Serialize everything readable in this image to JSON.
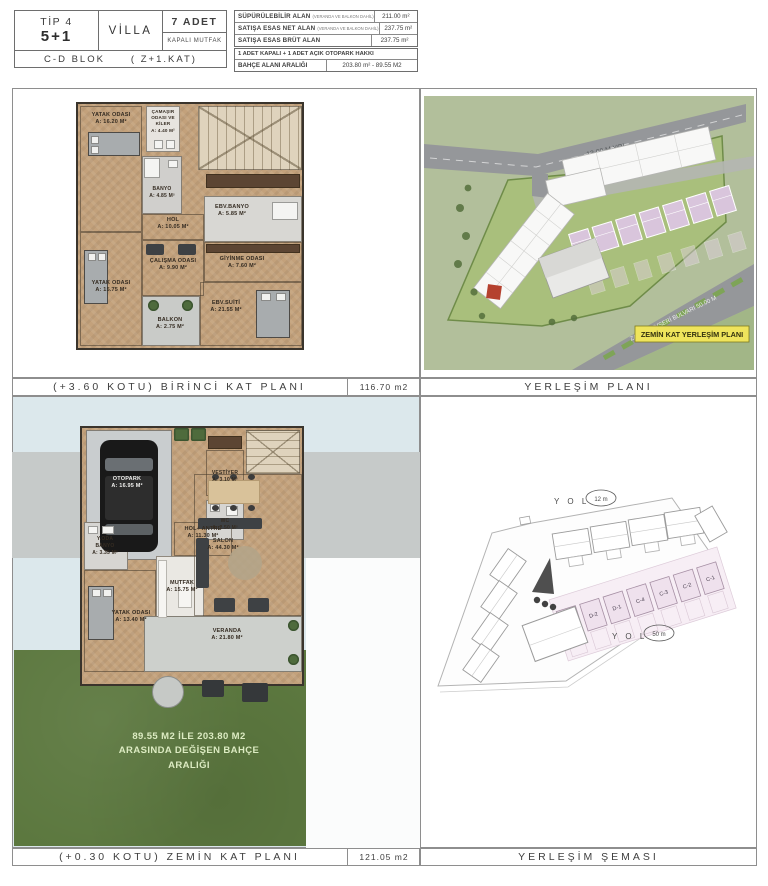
{
  "header": {
    "tip_line1": "TİP 4",
    "tip_line2": "5+1",
    "type": "VİLLA",
    "count": "7 ADET",
    "kitchen": "KAPALI MUTFAK",
    "block": "C-D BLOK",
    "floor": "( Z+1.KAT)",
    "area_rows": [
      {
        "label": "SÜPÜRÜLEBİLİR ALAN",
        "note": "(VERANDA VE BALKON DAHİL)",
        "value": "211.00 m²"
      },
      {
        "label": "SATIŞA ESAS NET ALAN",
        "note": "(VERANDA VE BALKON DAHİL)",
        "value": "237.75 m²"
      },
      {
        "label": "SATIŞA ESAS BRÜT ALAN",
        "note": "",
        "value": "237.75 m²"
      }
    ],
    "parking_note": "1 ADET KAPALI + 1 ADET AÇIK OTOPARK HAKKI",
    "garden_label": "BAHÇE ALANI ARALIĞI",
    "garden_value": "203.80 m² - 89.55 M2"
  },
  "colors": {
    "badge_bg": "#efe45c",
    "site_green": "#b2bf9b",
    "parcel_green": "#a9bf7c",
    "villa_pink": "#d9c5dc",
    "grass_green": "#5c783f",
    "wood": "#c3a17b"
  },
  "panels": {
    "first_floor": {
      "caption": "(+3.60 KOTU) BİRİNCİ KAT PLANI",
      "area": "116.70 m2",
      "rooms": {
        "bedroom1": {
          "name": "YATAK ODASI",
          "area": "A: 16.20 M²"
        },
        "laundry": {
          "name": "ÇAMAŞIR ODASI VE KİLER",
          "area": "A: 4.40 M²"
        },
        "banyo": {
          "name": "BANYO",
          "area": "A: 4.85 M²"
        },
        "hol": {
          "name": "HOL",
          "area": "A: 10.05 M²"
        },
        "ebv_banyo": {
          "name": "EBV.BANYO",
          "area": "A: 5.85 M²"
        },
        "calisma": {
          "name": "ÇALIŞMA ODASI",
          "area": "A: 9.90 M²"
        },
        "giyinme": {
          "name": "GİYİNME ODASI",
          "area": "A: 7.60 M²"
        },
        "bedroom2": {
          "name": "YATAK ODASI",
          "area": "A: 15.75 M²"
        },
        "balkon": {
          "name": "BALKON",
          "area": "A: 2.75 M²"
        },
        "suit": {
          "name": "EBV.SUİTİ",
          "area": "A: 21.55 M²"
        }
      }
    },
    "site_plan": {
      "caption": "YERLEŞİM PLANI",
      "road_label": "12.00 M YOL",
      "boulevard_label": "ZAHİD KEVSERİ BULVARI 50.00 M",
      "badge": "ZEMİN KAT YERLEŞİM PLANI"
    },
    "ground_floor": {
      "caption": "(+0.30 KOTU) ZEMİN KAT PLANI",
      "area": "121.05 m2",
      "rooms": {
        "otopark": {
          "name": "OTOPARK",
          "area": "A: 16.95 M²"
        },
        "vestiyer": {
          "name": "VESTİYER",
          "area": "A: 3.10 M²"
        },
        "wc": {
          "name": "WC",
          "area": "A: 2.50 M²"
        },
        "hol_antre": {
          "name": "HOL+ ANTRE",
          "area": "A: 11.30 M²"
        },
        "mutfak": {
          "name": "MUTFAK",
          "area": "A: 15.75 M²"
        },
        "yoda_banyo": {
          "name": "Y.ODA BANYO",
          "area": "A: 3.35 M²"
        },
        "yatak": {
          "name": "YATAK ODASI",
          "area": "A: 13.40 M²"
        },
        "salon": {
          "name": "SALON",
          "area": "A: 44.30 M²"
        },
        "veranda": {
          "name": "VERANDA",
          "area": "A: 21.80 M²"
        }
      },
      "garden_note_line1": "89.55 M2 İLE 203.80 M2",
      "garden_note_line2": "ARASINDA DEĞİŞEN BAHÇE ARALIĞI"
    },
    "site_schema": {
      "caption": "YERLEŞİM ŞEMASI",
      "yol": "Y O L",
      "road_top_value": "12 m",
      "road_bottom_value": "50 m",
      "units": [
        "D-3",
        "D-2",
        "D-1",
        "C-4",
        "C-3",
        "C-2",
        "C-1"
      ]
    }
  }
}
